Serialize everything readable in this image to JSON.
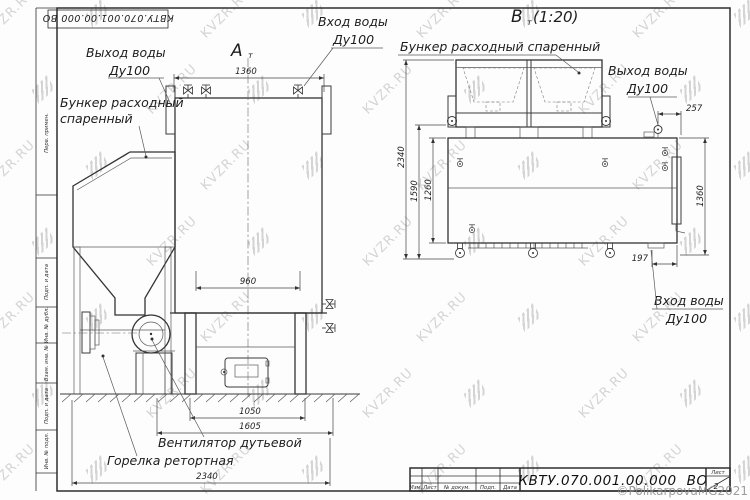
{
  "watermark": {
    "text": "KVZR.RU"
  },
  "copyright": "©PolikarpovaMG2021",
  "frame": {
    "top_stamp": "КВТУ.070.001.00.000 ВО",
    "left_fields": [
      "Перв. примен.",
      "Подп. и дата",
      "Инв. № дубл.",
      "Взам. инв. №",
      "Подп. и дата",
      "Инв. № подл."
    ]
  },
  "title_block": {
    "designation": "КВТУ.070.001.00.000 ВО",
    "columns": [
      "Изм.",
      "Лист",
      "№ докум.",
      "Подп.",
      "Дата"
    ],
    "sheet_label": "Лист",
    "sheet_value": "2"
  },
  "view_a": {
    "label": "А",
    "label_sub": "т",
    "callouts": {
      "water_out_1": "Выход воды",
      "water_out_2": "Ду100",
      "water_in_1": "Вход воды",
      "water_in_2": "Ду100",
      "bunker_1": "Бункер расходный",
      "bunker_2": "спаренный",
      "fan": "Вентилятор дутьевой",
      "burner": "Горелка ретортная"
    },
    "dims": {
      "d1360": "1360",
      "d960": "960",
      "d1050": "1050",
      "d1605": "1605",
      "d2340": "2340"
    }
  },
  "view_b": {
    "label": "В",
    "label_sub": "т",
    "scale": "(1:20)",
    "callouts": {
      "bunker": "Бункер расходный спаренный",
      "water_out_1": "Выход воды",
      "water_out_2": "Ду100",
      "water_in_1": "Вход воды",
      "water_in_2": "Ду100"
    },
    "dims": {
      "d257": "257",
      "d2340": "2340",
      "d1590": "1590",
      "d1260": "1260",
      "d1360": "1360",
      "d197": "197"
    }
  }
}
